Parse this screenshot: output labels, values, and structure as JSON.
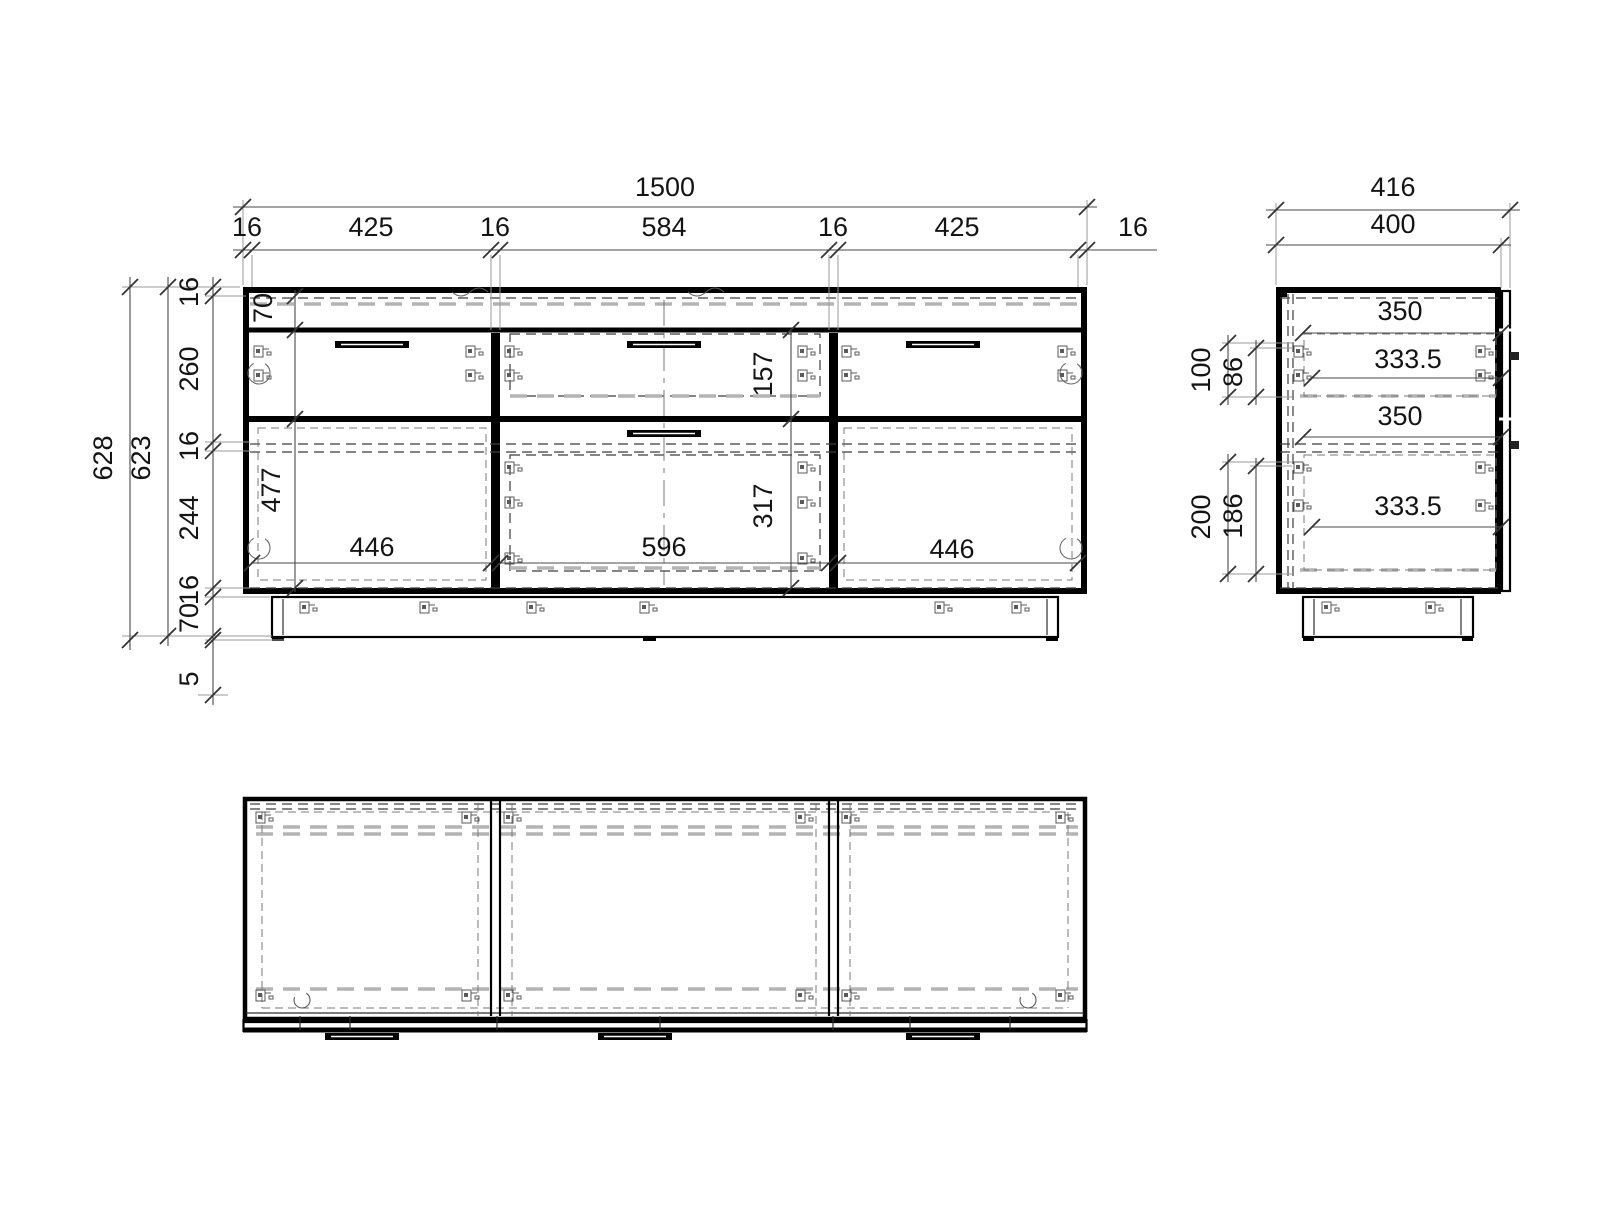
{
  "front": {
    "width_total": "1500",
    "width_segs": [
      "16",
      "425",
      "16",
      "584",
      "16",
      "425",
      "16"
    ],
    "height_outer": "628",
    "height_inner": "623",
    "height_segs": [
      "16",
      "260",
      "16",
      "244",
      "16",
      "70",
      "5"
    ],
    "rail_height": "70",
    "left_door_height": "477",
    "left_door_width": "446",
    "mid_top_drawer_height": "157",
    "mid_drawer_height": "317",
    "mid_drawer_width": "596",
    "right_door_width": "446"
  },
  "side": {
    "depth_total": "416",
    "depth_body": "400",
    "depths": [
      "350",
      "333.5",
      "350",
      "333.5"
    ],
    "upper_offset_outer": "100",
    "upper_offset_inner": "86",
    "lower_offset_outer": "200",
    "lower_offset_inner": "186"
  }
}
